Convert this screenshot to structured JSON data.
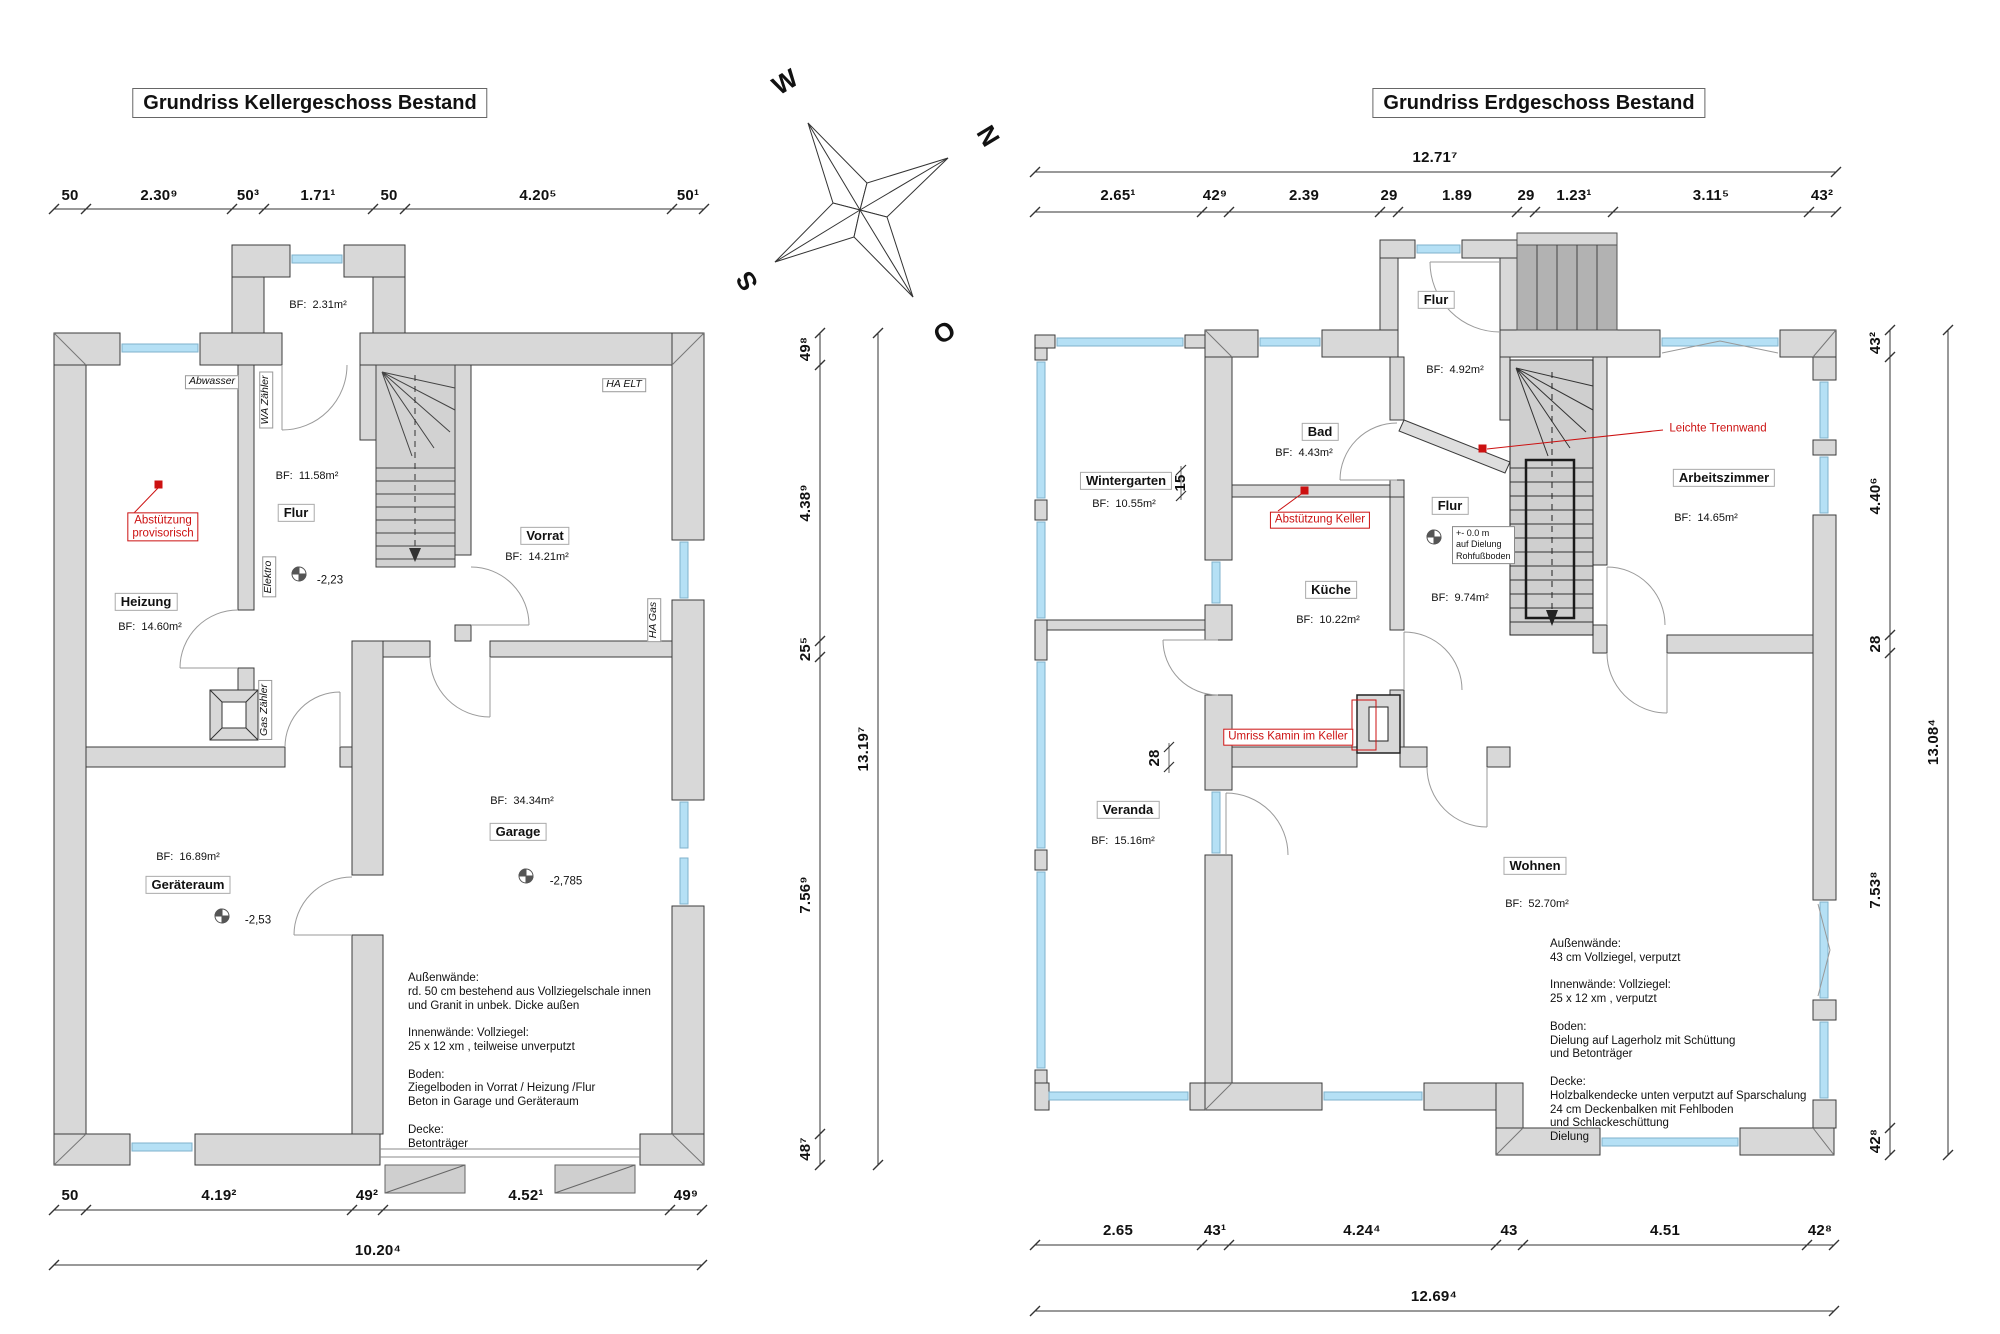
{
  "titles": {
    "keller": "Grundriss Kellergeschoss Bestand",
    "eg": "Grundriss Erdgeschoss Bestand"
  },
  "compass": {
    "w": "W",
    "n": "N",
    "s": "S",
    "o": "O"
  },
  "keller": {
    "dims_top": [
      "50",
      "2.30⁹",
      "50³",
      "1.71¹",
      "50",
      "4.20⁵",
      "50¹"
    ],
    "dims_bottom": [
      "50",
      "4.19²",
      "49²",
      "4.52¹",
      "49⁹"
    ],
    "dim_total_bottom": "10.20⁴",
    "dims_right": [
      "49⁸",
      "4.38⁹",
      "25⁵",
      "7.56⁹",
      "48⁷"
    ],
    "dim_total_right": "13.19⁷",
    "rooms": {
      "abstell": {
        "bf": "BF:  2.31m²"
      },
      "flur": {
        "name": "Flur",
        "bf": "BF:  11.58m²"
      },
      "vorrat": {
        "name": "Vorrat",
        "bf": "BF:  14.21m²"
      },
      "heizung": {
        "name": "Heizung",
        "bf": "BF:  14.60m²"
      },
      "geraeteraum": {
        "name": "Geräteraum",
        "bf": "BF:  16.89m²"
      },
      "garage": {
        "name": "Garage",
        "bf": "BF:  34.34m²"
      }
    },
    "levels": {
      "flur": "-2,23",
      "geraeteraum": "-2,53",
      "garage": "-2,785"
    },
    "utilities": {
      "abwasser": "Abwasser",
      "wa_zaehler": "WA Zähler",
      "elektro": "Elektro",
      "gas_zaehler": "Gas Zähler",
      "ha_elt": "HA ELT",
      "ha_gas": "HA Gas"
    },
    "annotations": {
      "abstuetzung": "Abstützung\nprovisorisch"
    },
    "notes": "Außenwände:\nrd. 50 cm bestehend aus Vollziegelschale innen\nund Granit in unbek. Dicke außen\n\nInnenwände: Vollziegel:\n25 x 12 xm , teilweise unverputzt\n\nBoden:\nZiegelboden in Vorrat / Heizung /Flur\nBeton in Garage und Geräteraum\n\nDecke:\nBetonträger"
  },
  "eg": {
    "dim_total_top": "12.71⁷",
    "dims_top": [
      "2.65¹",
      "42⁹",
      "2.39",
      "29",
      "1.89",
      "29",
      "1.23¹",
      "3.11⁵",
      "43²"
    ],
    "dims_bottom": [
      "2.65",
      "43¹",
      "4.24⁴",
      "43",
      "4.51",
      "42⁸"
    ],
    "dim_total_bottom": "12.69⁴",
    "dims_right": [
      "43²",
      "4.40⁶",
      "28",
      "7.53⁸",
      "42⁸"
    ],
    "dim_total_right": "13.08⁴",
    "dims_inner": {
      "wintergarten_wall": "15",
      "kueche_wall": "28"
    },
    "rooms": {
      "flur_eingang": {
        "name": "Flur",
        "bf": "BF:  4.92m²"
      },
      "bad": {
        "name": "Bad",
        "bf": "BF:  4.43m²"
      },
      "wintergarten": {
        "name": "Wintergarten",
        "bf": "BF:  10.55m²"
      },
      "kueche": {
        "name": "Küche",
        "bf": "BF:  10.22m²"
      },
      "flur": {
        "name": "Flur",
        "bf": "BF:  9.74m²"
      },
      "arbeitszimmer": {
        "name": "Arbeitszimmer",
        "bf": "BF:  14.65m²"
      },
      "veranda": {
        "name": "Veranda",
        "bf": "BF:  15.16m²"
      },
      "wohnen": {
        "name": "Wohnen",
        "bf": "BF:  52.70m²"
      }
    },
    "levels": {
      "flur": "+- 0.0 m\nauf Dielung\nRohfußboden"
    },
    "annotations": {
      "abstuetzung": "Abstützung Keller",
      "trennwand": "Leichte Trennwand",
      "kamin": "Umriss Kamin im Keller"
    },
    "notes": "Außenwände:\n43 cm Vollziegel, verputzt\n\nInnenwände: Vollziegel:\n25 x 12 xm , verputzt\n\nBoden:\nDielung auf Lagerholz mit Schüttung\nund Betonträger\n\nDecke:\nHolzbalkendecke unten verputzt auf Sparschalung\n24 cm Deckenbalken mit Fehlboden\nund Schlackeschüttung\nDielung"
  }
}
